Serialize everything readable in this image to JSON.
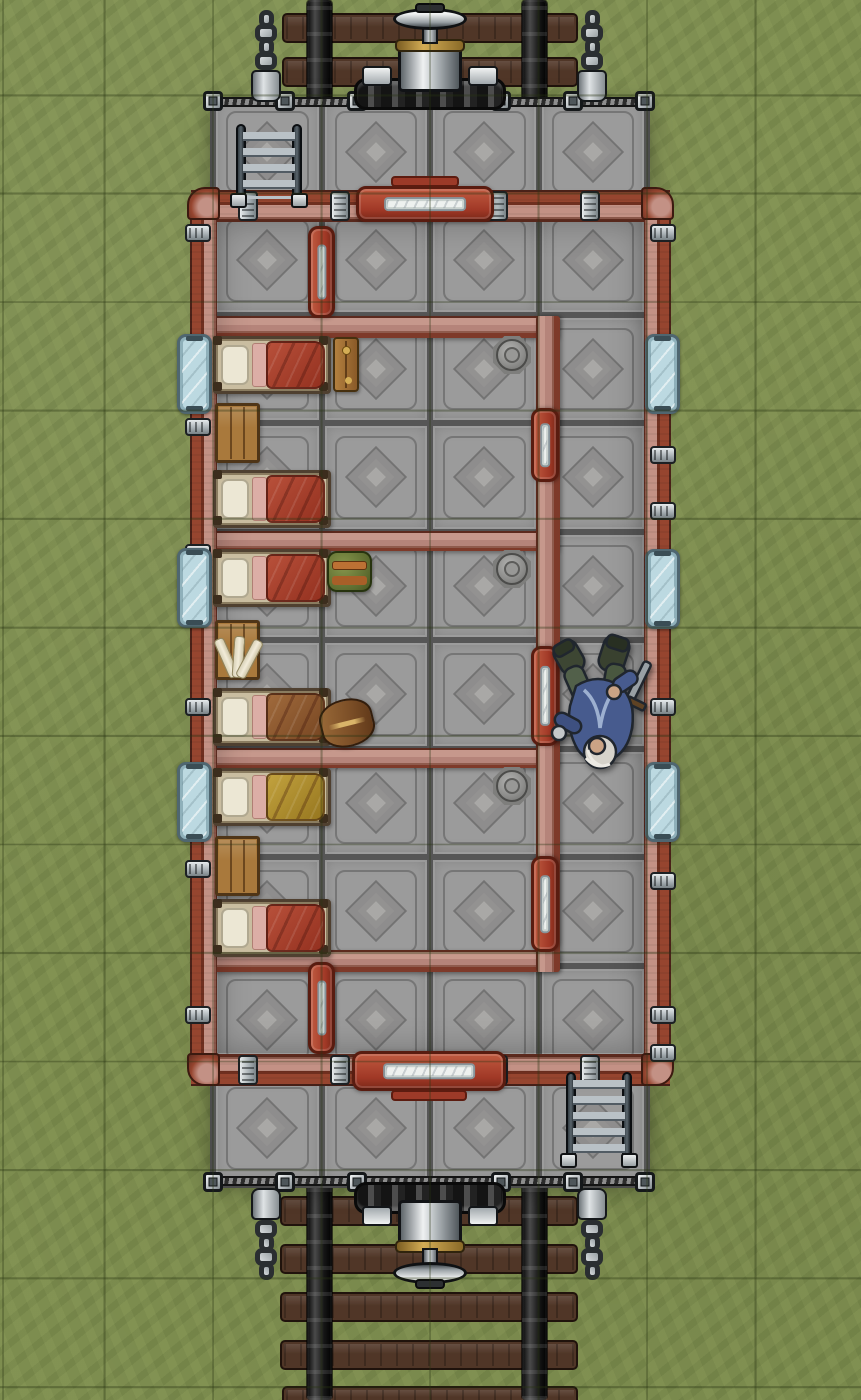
{
  "canvas": {
    "width": 861,
    "height": 1400
  },
  "grid": {
    "cell": 108.5,
    "offset_x": 104.5,
    "offset_y": 97.5,
    "line_rgba": "rgba(40,52,18,0.36)"
  },
  "palette": {
    "grass": "#7d8d4f",
    "plate": "#9b9b9b",
    "diamond": "#a9a8a6",
    "wall_pink": "#c39185",
    "pipe_red": "#96452f",
    "pipe_dark": "#5c2a1e",
    "door_red": "#a03826",
    "door_pane": "#eef1ef",
    "glass": "#bcd9e1",
    "glass_frame": "#4f6670",
    "wood": "#a9793c",
    "wood_dark": "#4f3517",
    "tie": "#503627",
    "bed_frame": "#c9bda0",
    "pillow": "#ece7d4",
    "sheet": "#dcaea6",
    "blanket_red": "#93301f",
    "blanket_brown": "#774622",
    "blanket_yellow": "#96761f",
    "brass": "#d4ad55",
    "coat_blue": "#475b8e"
  },
  "tracks": {
    "ties": [
      {
        "x": 282,
        "y": 13,
        "w": 296,
        "h": 30
      },
      {
        "x": 282,
        "y": 57,
        "w": 296,
        "h": 30
      },
      {
        "x": 280,
        "y": 1196,
        "w": 298,
        "h": 30
      },
      {
        "x": 280,
        "y": 1244,
        "w": 298,
        "h": 30
      },
      {
        "x": 280,
        "y": 1292,
        "w": 298,
        "h": 30
      },
      {
        "x": 280,
        "y": 1340,
        "w": 298,
        "h": 30
      },
      {
        "x": 282,
        "y": 1386,
        "w": 296,
        "h": 24
      }
    ],
    "rails": [
      {
        "x": 307,
        "y": 0,
        "w": 25,
        "h": 114
      },
      {
        "x": 522,
        "y": 0,
        "w": 25,
        "h": 114
      },
      {
        "x": 307,
        "y": 1183,
        "w": 25,
        "h": 217
      },
      {
        "x": 522,
        "y": 1183,
        "w": 25,
        "h": 217
      }
    ]
  },
  "platform": {
    "x": 213,
    "y": 107,
    "w": 434,
    "h": 1078,
    "tile": {
      "col_x": [
        0,
        108.5,
        217,
        325.5
      ],
      "col_w": 108.5,
      "row0": -9.5,
      "rows": 10,
      "row_h": 108.5
    }
  },
  "deck": {
    "railings": [
      {
        "x": 211,
        "y": 97,
        "w": 438,
        "h": 10
      },
      {
        "x": 211,
        "y": 1176,
        "w": 438,
        "h": 10
      }
    ],
    "posts": [
      {
        "x": 203,
        "y": 91
      },
      {
        "x": 275,
        "y": 91
      },
      {
        "x": 347,
        "y": 91
      },
      {
        "x": 491,
        "y": 91
      },
      {
        "x": 563,
        "y": 91
      },
      {
        "x": 635,
        "y": 91
      },
      {
        "x": 203,
        "y": 1172
      },
      {
        "x": 275,
        "y": 1172
      },
      {
        "x": 347,
        "y": 1172
      },
      {
        "x": 491,
        "y": 1172
      },
      {
        "x": 563,
        "y": 1172
      },
      {
        "x": 635,
        "y": 1172
      }
    ],
    "post_size": {
      "w": 20,
      "h": 20
    },
    "chains": [
      {
        "x": 248,
        "y": 14,
        "flip": false
      },
      {
        "x": 574,
        "y": 14,
        "flip": false
      },
      {
        "x": 248,
        "y": 1180,
        "flip": true
      },
      {
        "x": 574,
        "y": 1180,
        "flip": true
      }
    ],
    "couplers": [
      {
        "x": 352,
        "y": 4,
        "flip": false
      },
      {
        "x": 352,
        "y": 1182,
        "flip": true
      }
    ]
  },
  "cabin": {
    "outer_walls": [
      {
        "side": "top",
        "x": 191,
        "y": 190,
        "w": 479,
        "h": 32
      },
      {
        "side": "bottom",
        "x": 191,
        "y": 1054,
        "w": 479,
        "h": 32
      },
      {
        "side": "left",
        "x": 190,
        "y": 196,
        "w": 27,
        "h": 876
      },
      {
        "side": "right",
        "x": 644,
        "y": 196,
        "w": 27,
        "h": 876
      }
    ],
    "corners": [
      {
        "pos": "tl",
        "x": 187,
        "y": 187
      },
      {
        "pos": "tr",
        "x": 641,
        "y": 187
      },
      {
        "pos": "bl",
        "x": 187,
        "y": 1053
      },
      {
        "pos": "br",
        "x": 641,
        "y": 1053
      }
    ],
    "inner_walls": [
      {
        "dir": "h",
        "x": 214,
        "y": 316,
        "w": 346,
        "h": 22
      },
      {
        "dir": "h",
        "x": 214,
        "y": 531,
        "w": 346,
        "h": 20
      },
      {
        "dir": "h",
        "x": 214,
        "y": 748,
        "w": 346,
        "h": 20
      },
      {
        "dir": "h",
        "x": 214,
        "y": 950,
        "w": 346,
        "h": 22
      },
      {
        "dir": "v",
        "x": 536,
        "y": 316,
        "w": 24,
        "h": 656
      }
    ],
    "shade": {
      "x": 216,
      "y": 221,
      "w": 428,
      "h": 832
    },
    "clamps": [
      {
        "dir": "h",
        "x": 238,
        "y": 191,
        "w": 20,
        "h": 30
      },
      {
        "dir": "h",
        "x": 330,
        "y": 191,
        "w": 20,
        "h": 30
      },
      {
        "dir": "h",
        "x": 488,
        "y": 191,
        "w": 20,
        "h": 30
      },
      {
        "dir": "h",
        "x": 580,
        "y": 191,
        "w": 20,
        "h": 30
      },
      {
        "dir": "h",
        "x": 238,
        "y": 1055,
        "w": 20,
        "h": 30
      },
      {
        "dir": "h",
        "x": 330,
        "y": 1055,
        "w": 20,
        "h": 30
      },
      {
        "dir": "h",
        "x": 488,
        "y": 1055,
        "w": 20,
        "h": 30
      },
      {
        "dir": "h",
        "x": 580,
        "y": 1055,
        "w": 20,
        "h": 30
      },
      {
        "dir": "v",
        "x": 185,
        "y": 224,
        "w": 26,
        "h": 18
      },
      {
        "dir": "v",
        "x": 185,
        "y": 382,
        "w": 26,
        "h": 18
      },
      {
        "dir": "v",
        "x": 185,
        "y": 418,
        "w": 26,
        "h": 18
      },
      {
        "dir": "v",
        "x": 185,
        "y": 544,
        "w": 26,
        "h": 18
      },
      {
        "dir": "v",
        "x": 185,
        "y": 698,
        "w": 26,
        "h": 18
      },
      {
        "dir": "v",
        "x": 185,
        "y": 860,
        "w": 26,
        "h": 18
      },
      {
        "dir": "v",
        "x": 185,
        "y": 1006,
        "w": 26,
        "h": 18
      },
      {
        "dir": "v",
        "x": 650,
        "y": 224,
        "w": 26,
        "h": 18
      },
      {
        "dir": "v",
        "x": 650,
        "y": 446,
        "w": 26,
        "h": 18
      },
      {
        "dir": "v",
        "x": 650,
        "y": 502,
        "w": 26,
        "h": 18
      },
      {
        "dir": "v",
        "x": 650,
        "y": 698,
        "w": 26,
        "h": 18
      },
      {
        "dir": "v",
        "x": 650,
        "y": 872,
        "w": 26,
        "h": 18
      },
      {
        "dir": "v",
        "x": 650,
        "y": 1006,
        "w": 26,
        "h": 18
      },
      {
        "dir": "v",
        "x": 650,
        "y": 1044,
        "w": 26,
        "h": 18
      }
    ]
  },
  "openings": {
    "windows": [
      {
        "name": "window-left-1",
        "x": 177,
        "y": 334,
        "w": 35,
        "h": 80
      },
      {
        "name": "window-left-2",
        "x": 177,
        "y": 548,
        "w": 35,
        "h": 80
      },
      {
        "name": "window-left-3",
        "x": 177,
        "y": 762,
        "w": 35,
        "h": 80
      },
      {
        "name": "window-right-1",
        "x": 645,
        "y": 334,
        "w": 35,
        "h": 80
      },
      {
        "name": "window-right-2",
        "x": 645,
        "y": 549,
        "w": 35,
        "h": 80
      },
      {
        "name": "window-right-3",
        "x": 645,
        "y": 762,
        "w": 35,
        "h": 80
      }
    ],
    "doors": [
      {
        "kind": "slide-h",
        "name": "entry-door-north",
        "x": 356,
        "y": 186,
        "w": 138,
        "h": 36,
        "step": "top"
      },
      {
        "kind": "slide-h",
        "name": "entry-door-south",
        "x": 352,
        "y": 1051,
        "w": 154,
        "h": 40,
        "step": "bottom"
      },
      {
        "kind": "vest",
        "name": "vestibule-door-north",
        "x": 308,
        "y": 226,
        "w": 27,
        "h": 92
      },
      {
        "kind": "vest",
        "name": "vestibule-door-south",
        "x": 308,
        "y": 962,
        "w": 27,
        "h": 92
      },
      {
        "kind": "slide-v",
        "name": "compartment-door-1",
        "x": 531,
        "y": 408,
        "w": 28,
        "h": 74
      },
      {
        "kind": "slide-v",
        "name": "compartment-door-2",
        "x": 531,
        "y": 646,
        "w": 28,
        "h": 100
      },
      {
        "kind": "slide-v",
        "name": "compartment-door-3",
        "x": 531,
        "y": 856,
        "w": 28,
        "h": 96
      }
    ]
  },
  "floor_features": {
    "manholes": [
      {
        "x": 493,
        "y": 336
      },
      {
        "x": 493,
        "y": 550
      },
      {
        "x": 493,
        "y": 767
      }
    ],
    "manhole_size": 38
  },
  "furniture": {
    "ladders": [
      {
        "name": "boarding-ladder-north",
        "x": 233,
        "y": 124,
        "w": 72,
        "h": 80
      },
      {
        "name": "boarding-ladder-south",
        "x": 563,
        "y": 1072,
        "w": 72,
        "h": 92
      }
    ],
    "beds": [
      {
        "name": "bunk-bed-1",
        "x": 213,
        "y": 336,
        "w": 118,
        "h": 58,
        "blanket": "red"
      },
      {
        "name": "bunk-bed-2",
        "x": 213,
        "y": 470,
        "w": 118,
        "h": 58,
        "blanket": "red"
      },
      {
        "name": "bunk-bed-3",
        "x": 213,
        "y": 549,
        "w": 118,
        "h": 58,
        "blanket": "red"
      },
      {
        "name": "bunk-bed-4",
        "x": 213,
        "y": 688,
        "w": 118,
        "h": 58,
        "blanket": "brown"
      },
      {
        "name": "bunk-bed-5",
        "x": 213,
        "y": 768,
        "w": 118,
        "h": 58,
        "blanket": "yellow"
      },
      {
        "name": "bunk-bed-6",
        "x": 213,
        "y": 899,
        "w": 118,
        "h": 58,
        "blanket": "red"
      }
    ],
    "tables": [
      {
        "name": "side-table-1",
        "x": 215,
        "y": 403,
        "w": 45,
        "h": 60
      },
      {
        "name": "side-table-2",
        "x": 215,
        "y": 620,
        "w": 45,
        "h": 60
      },
      {
        "name": "side-table-3",
        "x": 215,
        "y": 836,
        "w": 45,
        "h": 60
      }
    ],
    "items": [
      {
        "type": "bench",
        "name": "wooden-bench",
        "x": 333,
        "y": 337,
        "w": 26,
        "h": 55
      },
      {
        "type": "satchel",
        "name": "travel-satchel",
        "x": 327,
        "y": 551,
        "w": 45,
        "h": 41
      },
      {
        "type": "bedroll",
        "name": "leather-bedroll",
        "x": 320,
        "y": 699,
        "w": 54,
        "h": 48,
        "rot": -14
      },
      {
        "type": "scrolls",
        "name": "scroll-bundle",
        "x": 220,
        "y": 634,
        "w": 40,
        "h": 50
      }
    ]
  },
  "tokens": [
    {
      "name": "token-fallen-dwarf",
      "x": 548,
      "y": 630,
      "w": 104,
      "h": 152
    }
  ]
}
